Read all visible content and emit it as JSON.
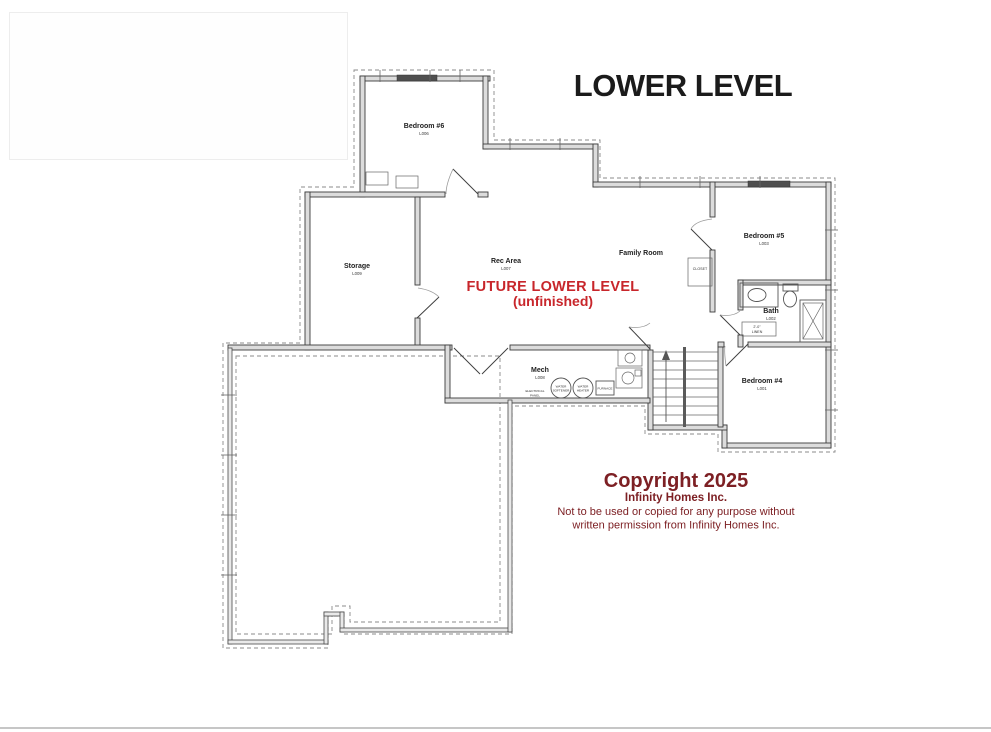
{
  "title": "LOWER LEVEL",
  "future": {
    "line1": "FUTURE LOWER LEVEL",
    "line2": "(unfinished)"
  },
  "rooms": {
    "bedroom6": {
      "name": "Bedroom #6",
      "code": "L006"
    },
    "storage": {
      "name": "Storage",
      "code": "L009"
    },
    "rec": {
      "name": "Rec Area",
      "code": "L007"
    },
    "family": {
      "name": "Family Room"
    },
    "bedroom5": {
      "name": "Bedroom #5",
      "code": "L003"
    },
    "bath": {
      "name": "Bath",
      "code": "L002"
    },
    "bedroom4": {
      "name": "Bedroom #4",
      "code": "L001"
    },
    "mech": {
      "name": "Mech",
      "code": "L008"
    }
  },
  "annotations": {
    "closet": "CLOSET",
    "linen_dim": "2'-0\"",
    "linen": "LINEN",
    "electrical_1": "ELECTRICAL",
    "electrical_2": "PANEL",
    "softener_1": "WATER",
    "softener_2": "SOFTENER",
    "heater_1": "WATER",
    "heater_2": "HEATER",
    "furnace": "FURNACE"
  },
  "copyright": {
    "line1": "Copyright 2025",
    "line2": "Infinity Homes Inc.",
    "line3": "Not to be used or copied for any purpose without",
    "line4": "written permission from Infinity Homes Inc."
  },
  "colors": {
    "accent_red": "#c8262b",
    "copyright_maroon": "#7d2024",
    "title_black": "#1b1b1b"
  }
}
